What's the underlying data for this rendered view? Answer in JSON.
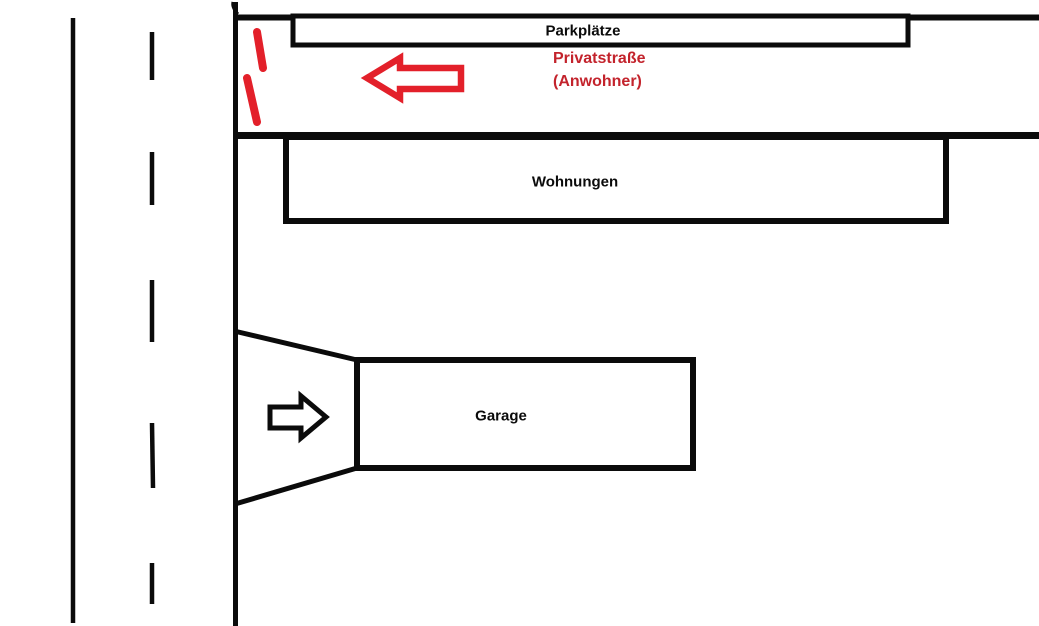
{
  "title": "Hand-drawn street and parking situation sketch",
  "colors": {
    "ink": "#0b0b0b",
    "marker_red": "#e3202a",
    "text_red": "#c3232c",
    "background": "#ffffff"
  },
  "labels": {
    "parking": "Parkplätze",
    "private_street": "Privatstraße",
    "private_street_note": "(Anwohner)",
    "apartments": "Wohnungen",
    "garage": "Garage"
  },
  "icons": {
    "red_left_arrow": "left-arrow",
    "black_right_arrow": "right-arrow",
    "red_dashes": "no-entry-barrier-marks"
  }
}
